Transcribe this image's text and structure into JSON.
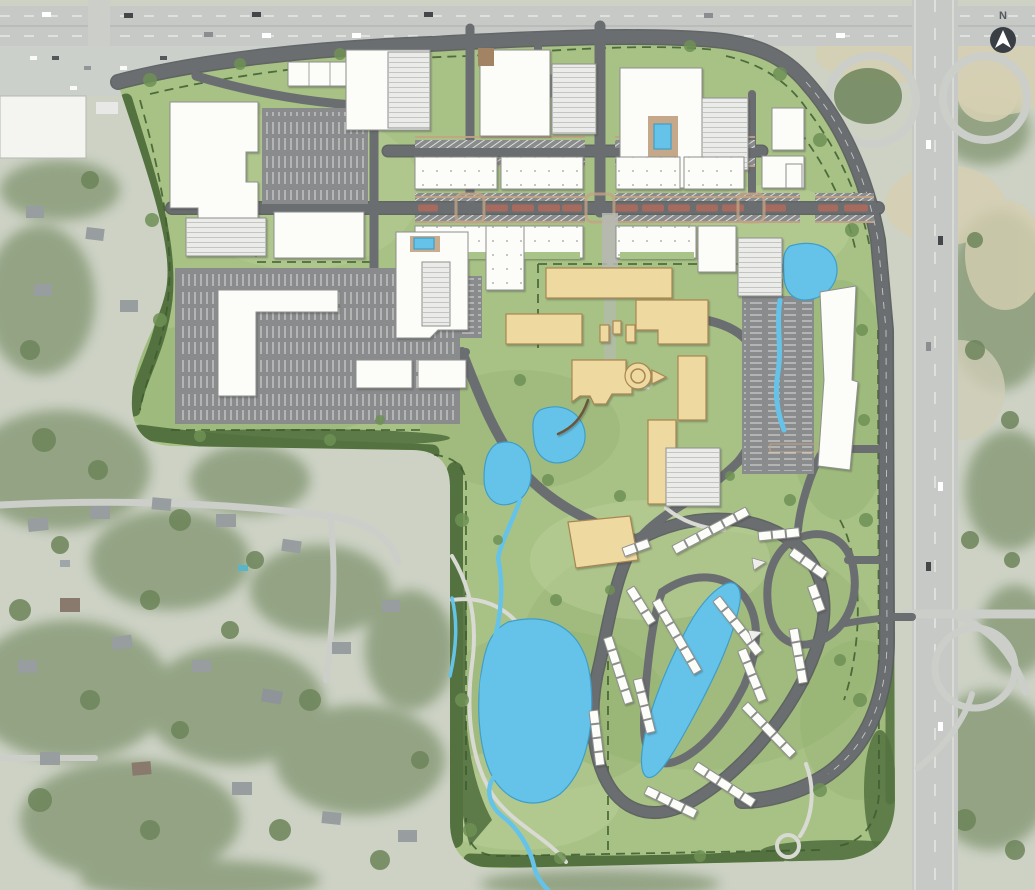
{
  "page": {
    "type": "aerial-site-plan-rendering"
  },
  "compass": {
    "label": "N",
    "icon": "north-arrow-icon"
  },
  "colors": {
    "aerial_base": "#cdd2c5",
    "aerial_road": "#cbcec9",
    "aerial_grass_tan": "#d6cfb2",
    "aerial_tree": "#6d855a",
    "aerial_house": "#989da0",
    "site_lawn": "#a8c286",
    "site_lawn_dark": "#93b271",
    "site_lawn_light": "#bad098",
    "buffer_green": "#537240",
    "boundary_dash": "#3e5c2f",
    "road_gray": "#6b6e70",
    "road_edge": "#585b5d",
    "path_light": "#d9dad4",
    "plaza_gray": "#b8b9b5",
    "parking_gray": "#898b8d",
    "stall_white": "#dddedb",
    "building_white": "#fcfcf9",
    "building_outline": "#8e908e",
    "garage_fill": "#ebece9",
    "garage_line": "#c3c5c1",
    "campus_tan": "#eedaa1",
    "campus_outline": "#a9864f",
    "water_blue": "#65c3e9",
    "water_outline": "#3f9ec9",
    "median_red": "#a66a5e",
    "sidewalk_tan": "#c2a384",
    "green_roof": "#a9c489",
    "site_tree": "#6e9155",
    "compass_bg": "#3a3f45",
    "compass_fg": "#ffffff",
    "compass_text": "#55595e"
  }
}
